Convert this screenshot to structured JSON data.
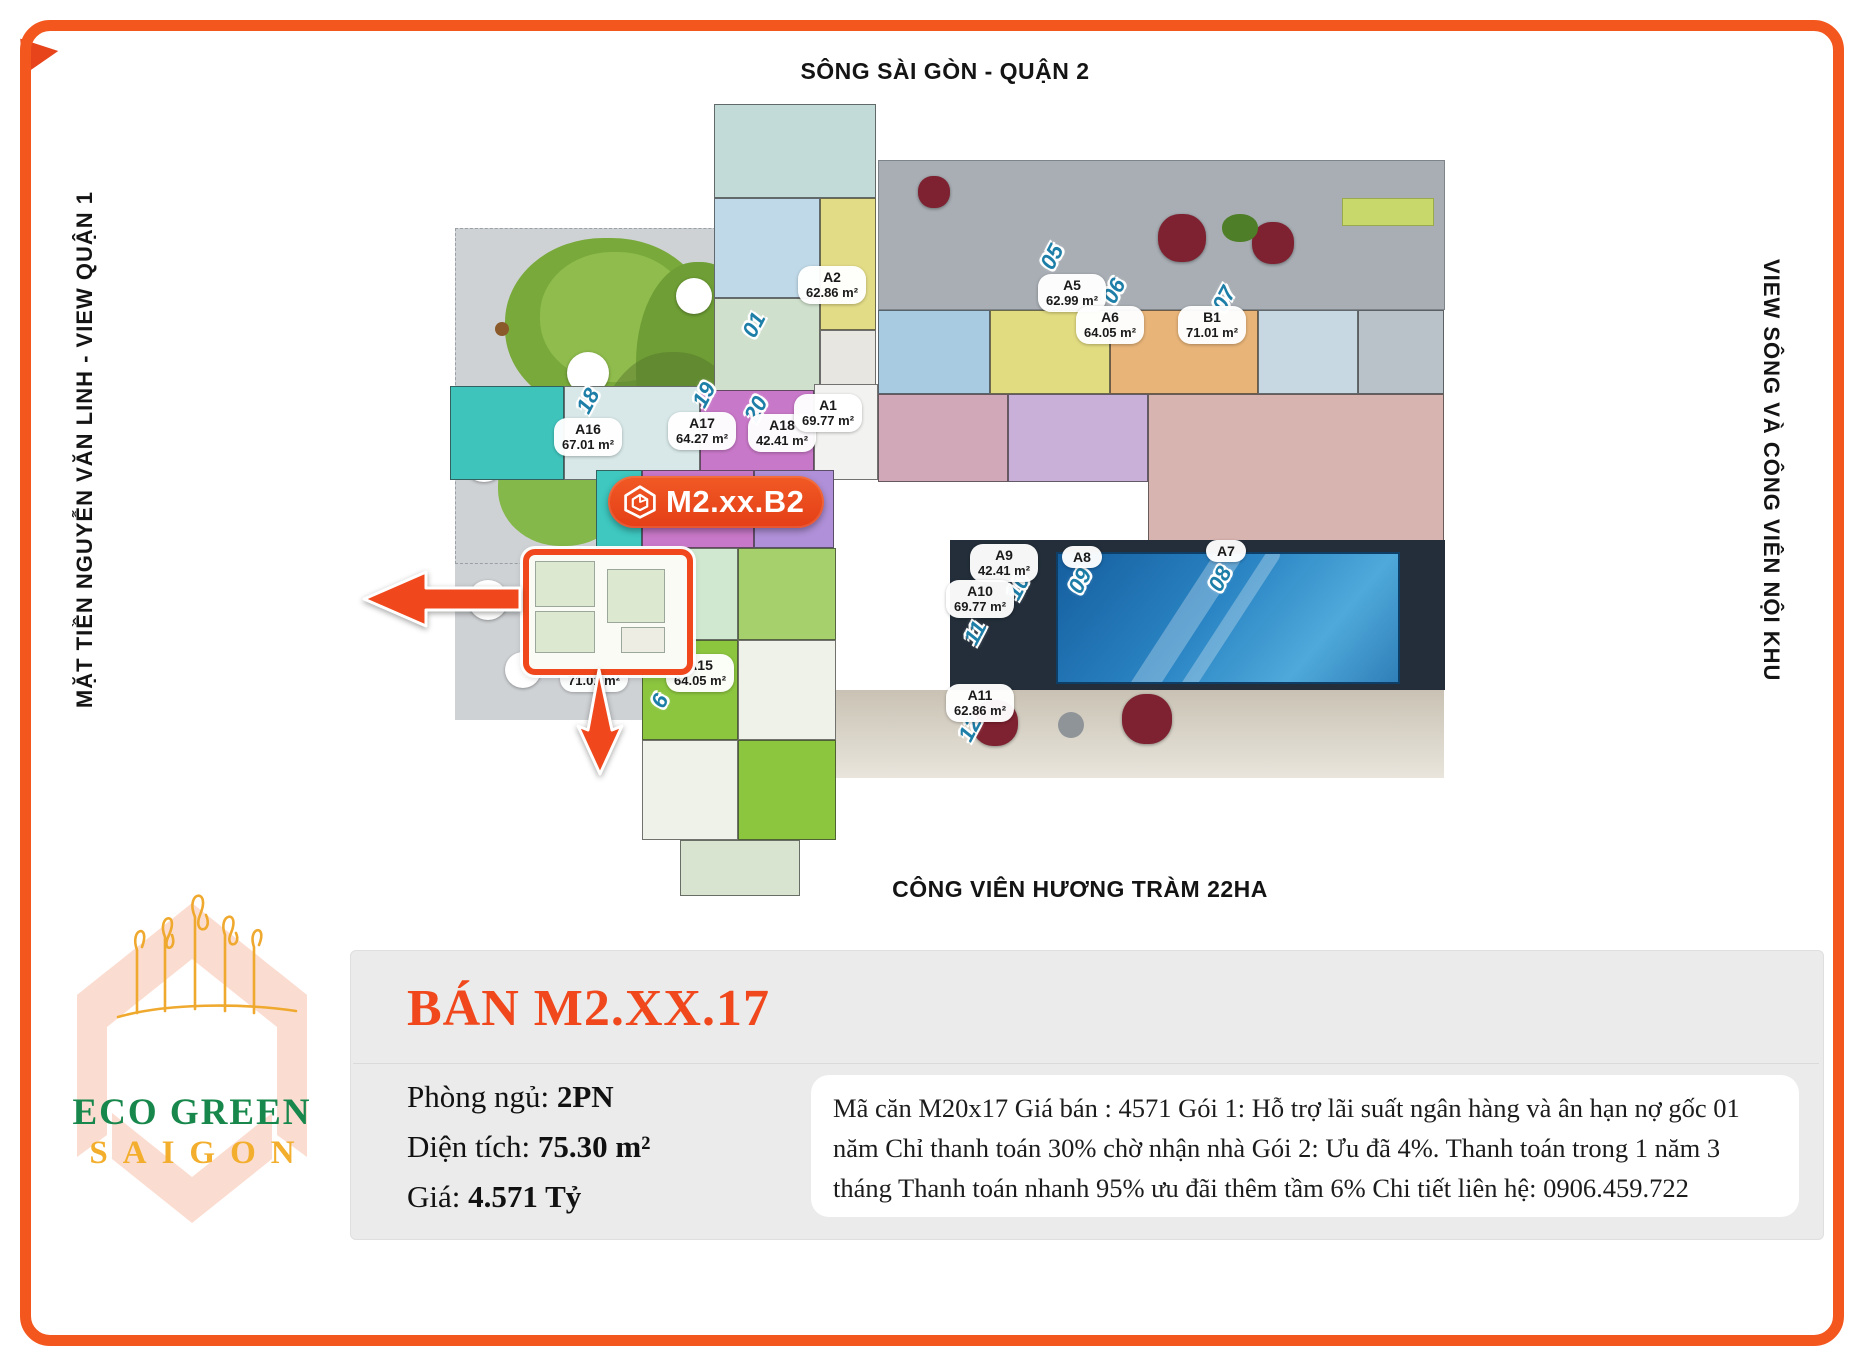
{
  "map_labels": {
    "top": "SÔNG SÀI GÒN - QUẬN 2",
    "left": "MẶT TIỀN NGUYỄN VĂN LINH - VIEW QUẬN 1",
    "right": "VIEW SÔNG VÀ CÔNG VIÊN NỘI KHU",
    "bottom": "CÔNG VIÊN HƯƠNG TRÀM 22HA"
  },
  "floorplan": {
    "callout": {
      "label": "M2.xx.B2"
    },
    "units": [
      {
        "id": "A2",
        "area": "62.86 m²"
      },
      {
        "id": "A5",
        "area": "62.99 m²"
      },
      {
        "id": "A6",
        "area": "64.05 m²"
      },
      {
        "id": "B1",
        "area": "71.01 m²"
      },
      {
        "id": "A16",
        "area": "67.01 m²"
      },
      {
        "id": "A17",
        "area": "64.27 m²"
      },
      {
        "id": "A18",
        "area": "42.41 m²"
      },
      {
        "id": "A1",
        "area": "69.77 m²"
      },
      {
        "id": "A9",
        "area": "42.41 m²"
      },
      {
        "id": "A10",
        "area": "69.77 m²"
      },
      {
        "id": "A8",
        "area": ""
      },
      {
        "id": "A7",
        "area": ""
      },
      {
        "id": "A11",
        "area": "62.86 m²"
      },
      {
        "id": "B2",
        "area": "71.01 m²"
      },
      {
        "id": "A15",
        "area": "64.05 m²"
      }
    ],
    "axis_numbers": [
      "18",
      "19",
      "20",
      "01",
      "05",
      "06",
      "07",
      "10",
      "09",
      "08",
      "11",
      "12",
      "6"
    ]
  },
  "listing": {
    "title": "BÁN M2.XX.17",
    "bedrooms_label": "Phòng ngủ:",
    "bedrooms_value": "2PN",
    "area_label": "Diện tích:",
    "area_value": "75.30 m²",
    "price_label": "Giá:",
    "price_value": "4.571 Tỷ",
    "description": "Mã căn M20x17 Giá bán : 4571 Gói 1: Hỗ trợ lãi suất ngân hàng và ân hạn nợ gốc 01 năm Chỉ thanh toán 30% chờ nhận nhà Gói 2: Ưu đã 4%. Thanh toán trong 1 năm 3 tháng Thanh toán nhanh 95% ưu đãi thêm tầm 6% Chi tiết liên hệ: 0906.459.722"
  },
  "logo": {
    "line1": "ECO GREEN",
    "line2": "SAIGON"
  },
  "colors": {
    "frame_orange": "#F4571E",
    "title_orange": "#F0481C",
    "pool_blue": "#2B85C4",
    "axis_blue": "#1D7FA8",
    "logo_green": "#17874B",
    "logo_gold": "#F2AE2C"
  }
}
